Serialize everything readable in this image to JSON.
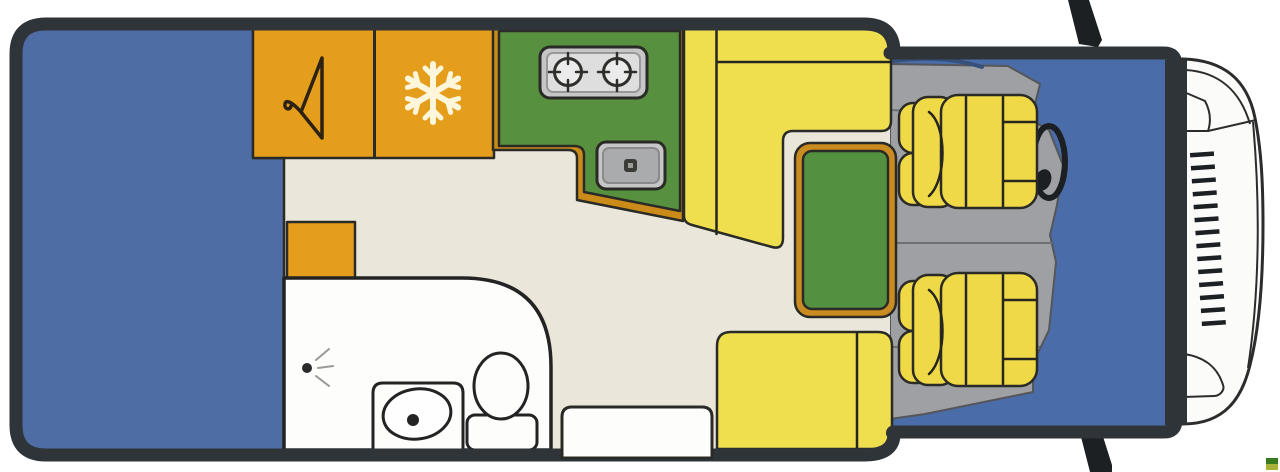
{
  "scene": {
    "kind": "motorhome-floorplan-top-view",
    "width": 1280,
    "height": 472
  },
  "palette": {
    "background": "#ffffff",
    "wall": "#2f3438",
    "floor": "#eae7da",
    "bed": "#4d6da4",
    "cab_floor_blue": "#4a6ca8",
    "cab_floor_gray": "#9ea0a4",
    "dash_shadow": "#36507c",
    "cabinet_orange": "#e59d1c",
    "kitchen_green": "#579140",
    "kitchen_border": "#cb8b19",
    "sofa_yellow": "#efdf4e",
    "seat_yellow": "#f0d947",
    "table_green": "#539040",
    "table_frame": "#ca8b20",
    "appliance_gray": "#c6c6c6",
    "appliance_inner": "#dedede",
    "sink_inner": "#a9abad",
    "drain_dark": "#3b3b38",
    "bath_white": "#fdfdfc",
    "front_white": "#fbfbfa",
    "windshield": "#d7e6ea",
    "dark_detail": "#1d2023",
    "icon_cream": "#fdf6da",
    "hanger_dark": "#2c2212",
    "logo_green": "#3a7a1f",
    "logo_olive": "#a8b238"
  },
  "regions": {
    "rear_bed": "bed",
    "wardrobe": "wardrobe-cabinet",
    "fridge": "fridge-cabinet",
    "kitchen": "kitchen-counter",
    "dinette": "l-shaped-dinette-sofa",
    "table": "dinette-table",
    "bench": "travel-bench-seat",
    "bathroom": "bathroom",
    "entry_step": "entry-step",
    "cab": "driver-cab",
    "front": "vehicle-front"
  },
  "icons": [
    "hanger-icon",
    "snowflake-icon",
    "stove-burner-icon",
    "sink-drain-icon",
    "shower-spray-icon",
    "washbasin-icon",
    "toilet-icon",
    "steering-wheel-icon",
    "side-mirror-icon",
    "grille-icon",
    "brand-mark"
  ]
}
